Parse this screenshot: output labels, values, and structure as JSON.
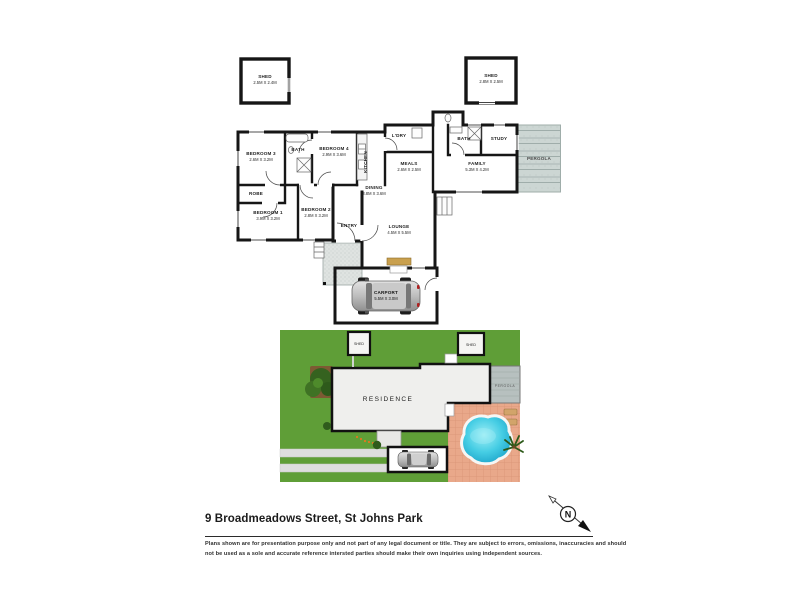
{
  "title": "9 Broadmeadows Street, St Johns Park",
  "disclaimer": {
    "line1": "Plans shown are for presentation purpose only and not part of any legal document or title. They are subject to errors, omissions, inaccuracies and should",
    "line2": "not be used as a sole and accurate reference intersted parties should make their own inquiries using independent sources."
  },
  "compass": {
    "north_label": "N"
  },
  "floorplan": {
    "sheds": [
      {
        "name": "SHED",
        "dims": "2.5M X 2.4M"
      },
      {
        "name": "SHED",
        "dims": "2.8M X 2.5M"
      }
    ],
    "rooms": [
      {
        "name": "BEDROOM 3",
        "dims": "2.6M X 3.2M"
      },
      {
        "name": "BATH",
        "dims": ""
      },
      {
        "name": "BEDROOM 4",
        "dims": "2.9M X 3.6M"
      },
      {
        "name": "ROBE",
        "dims": ""
      },
      {
        "name": "BEDROOM 1",
        "dims": "3.9M X 3.2M"
      },
      {
        "name": "BEDROOM 2",
        "dims": "2.8M X 3.2M"
      },
      {
        "name": "ENTRY",
        "dims": ""
      },
      {
        "name": "DINING",
        "dims": "3.8M X 3.6M"
      },
      {
        "name": "MEALS",
        "dims": "2.6M X 2.5M"
      },
      {
        "name": "L'DRY",
        "dims": ""
      },
      {
        "name": "KITCHEN",
        "dims": ""
      },
      {
        "name": "LOUNGE",
        "dims": "4.5M X 5.5M"
      },
      {
        "name": "FAMILY",
        "dims": "5.3M X 4.2M"
      },
      {
        "name": "STUDY",
        "dims": ""
      },
      {
        "name": "BATH",
        "dims": ""
      },
      {
        "name": "PERGOLA",
        "dims": ""
      }
    ],
    "carport": {
      "name": "CARPORT",
      "dims": "5.5M X 3.0M"
    }
  },
  "siteplan": {
    "residence_label": "RESIDENCE",
    "shed_left_label": "SHED",
    "shed_right_label": "SHED",
    "pergola_label": "PERGOLA"
  },
  "colors": {
    "wall": "#161616",
    "lawn": "#5f9e37",
    "tree": "#35621f",
    "soil": "#7d5a33",
    "paving": "#e9a88a",
    "pool_water": "#45cde4",
    "pergola": "#b7c0bf",
    "porch_stipple": "#dfe3e1",
    "deck": "#c9a04e",
    "flower_accent": "#e07820"
  }
}
